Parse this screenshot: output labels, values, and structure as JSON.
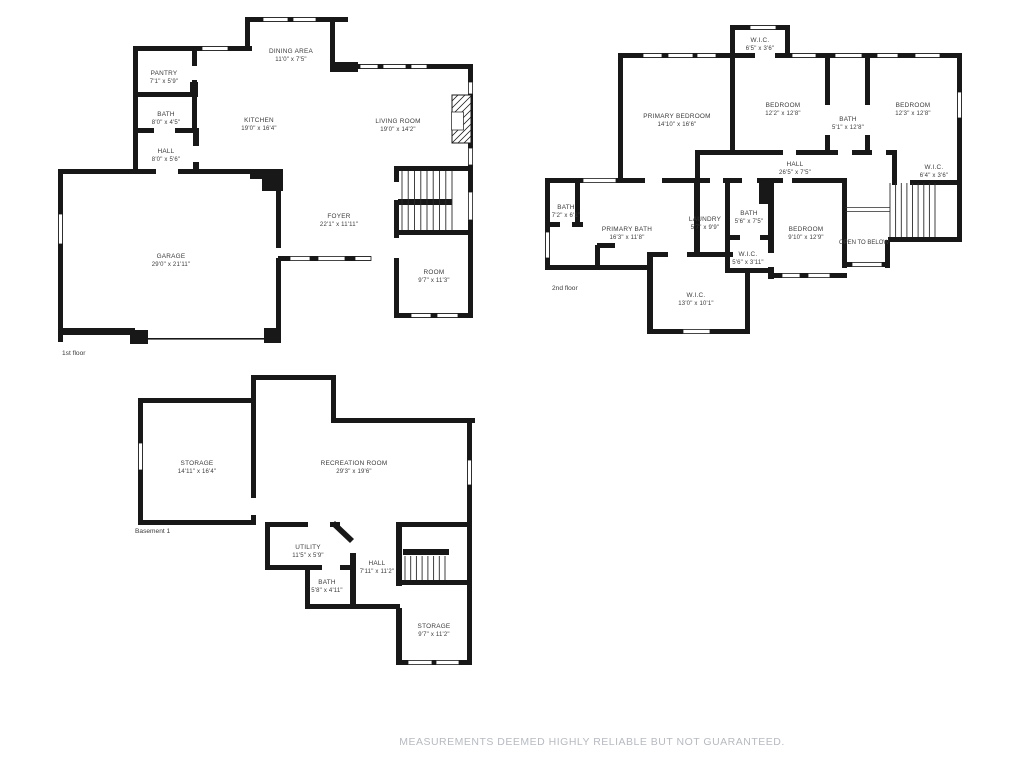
{
  "floors": {
    "first": {
      "label": "1st floor",
      "rooms": [
        {
          "name": "PANTRY",
          "dims": "7'1\" x 5'9\""
        },
        {
          "name": "BATH",
          "dims": "8'0\" x 4'5\""
        },
        {
          "name": "HALL",
          "dims": "8'0\" x 5'6\""
        },
        {
          "name": "DINING AREA",
          "dims": "11'0\" x 7'5\""
        },
        {
          "name": "KITCHEN",
          "dims": "19'0\" x 16'4\""
        },
        {
          "name": "LIVING ROOM",
          "dims": "19'0\" x 14'2\""
        },
        {
          "name": "FOYER",
          "dims": "22'1\" x 11'11\""
        },
        {
          "name": "GARAGE",
          "dims": "29'0\" x 21'11\""
        },
        {
          "name": "ROOM",
          "dims": "9'7\" x 11'3\""
        }
      ]
    },
    "second": {
      "label": "2nd floor",
      "open_to_below": "OPEN TO BELOW",
      "rooms": [
        {
          "name": "W.I.C.",
          "dims": "6'5\" x 3'6\""
        },
        {
          "name": "PRIMARY BEDROOM",
          "dims": "14'10\" x 16'6\""
        },
        {
          "name": "BEDROOM",
          "dims": "12'2\" x 12'8\""
        },
        {
          "name": "BATH",
          "dims": "5'1\" x 12'8\""
        },
        {
          "name": "BEDROOM",
          "dims": "12'3\" x 12'8\""
        },
        {
          "name": "HALL",
          "dims": "26'5\" x 7'5\""
        },
        {
          "name": "W.I.C.",
          "dims": "6'4\" x 3'6\""
        },
        {
          "name": "BATH",
          "dims": "7'2\" x 6'1\""
        },
        {
          "name": "PRIMARY BATH",
          "dims": "16'3\" x 11'8\""
        },
        {
          "name": "LAUNDRY",
          "dims": "5'7\" x 9'9\""
        },
        {
          "name": "BATH",
          "dims": "5'6\" x 7'5\""
        },
        {
          "name": "BEDROOM",
          "dims": "9'10\" x 12'9\""
        },
        {
          "name": "W.I.C.",
          "dims": "5'6\" x 3'11\""
        },
        {
          "name": "W.I.C.",
          "dims": "13'0\" x 10'1\""
        }
      ]
    },
    "basement": {
      "label": "Basement 1",
      "rooms": [
        {
          "name": "STORAGE",
          "dims": "14'11\" x 16'4\""
        },
        {
          "name": "RECREATION ROOM",
          "dims": "29'3\" x 19'6\""
        },
        {
          "name": "UTILITY",
          "dims": "11'5\" x 5'9\""
        },
        {
          "name": "HALL",
          "dims": "7'11\" x 11'2\""
        },
        {
          "name": "BATH",
          "dims": "5'8\" x 4'11\""
        },
        {
          "name": "STORAGE",
          "dims": "9'7\" x 11'2\""
        }
      ]
    }
  },
  "disclaimer": "MEASUREMENTS DEEMED HIGHLY RELIABLE BUT NOT GUARANTEED.",
  "colors": {
    "wall": "#181818",
    "label_text": "#3b3b3b",
    "disclaimer_text": "#b6bac0",
    "background": "#ffffff"
  }
}
